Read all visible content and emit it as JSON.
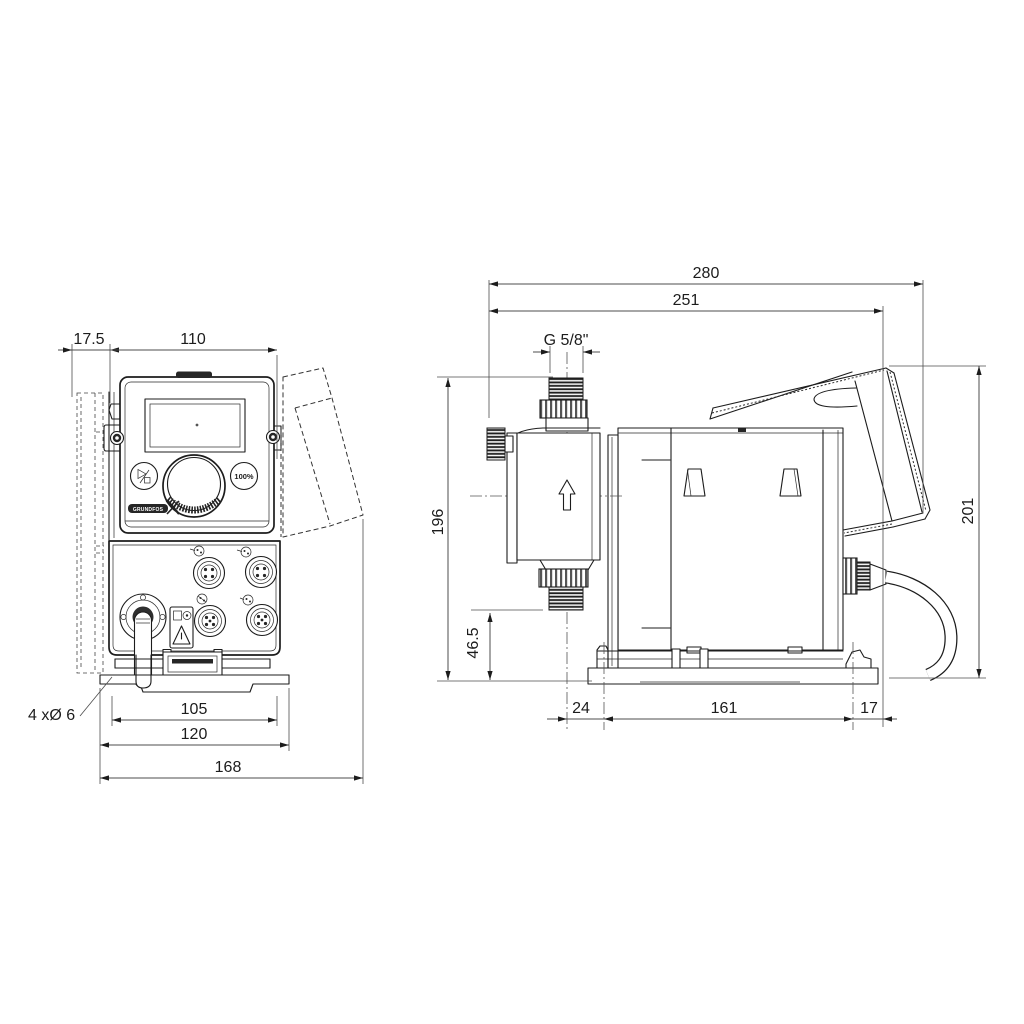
{
  "front_view": {
    "dims": {
      "offset": "17.5",
      "width": "110",
      "hole_spacing_x": "105",
      "plate_width": "120",
      "total_width": "168"
    },
    "holes_note": "4 xØ 6",
    "controls": {
      "percent_button": "100%",
      "brand": "GRUNDFOS"
    }
  },
  "side_view": {
    "dims": {
      "total_depth": "280",
      "depth_to_cover_edge": "251",
      "connection_thread": "G 5/8\"",
      "height_to_discharge": "196",
      "height_to_suction": "46.5",
      "base_front_offset": "24",
      "hole_spacing_y": "161",
      "base_rear_offset": "17",
      "total_height": "201"
    }
  }
}
